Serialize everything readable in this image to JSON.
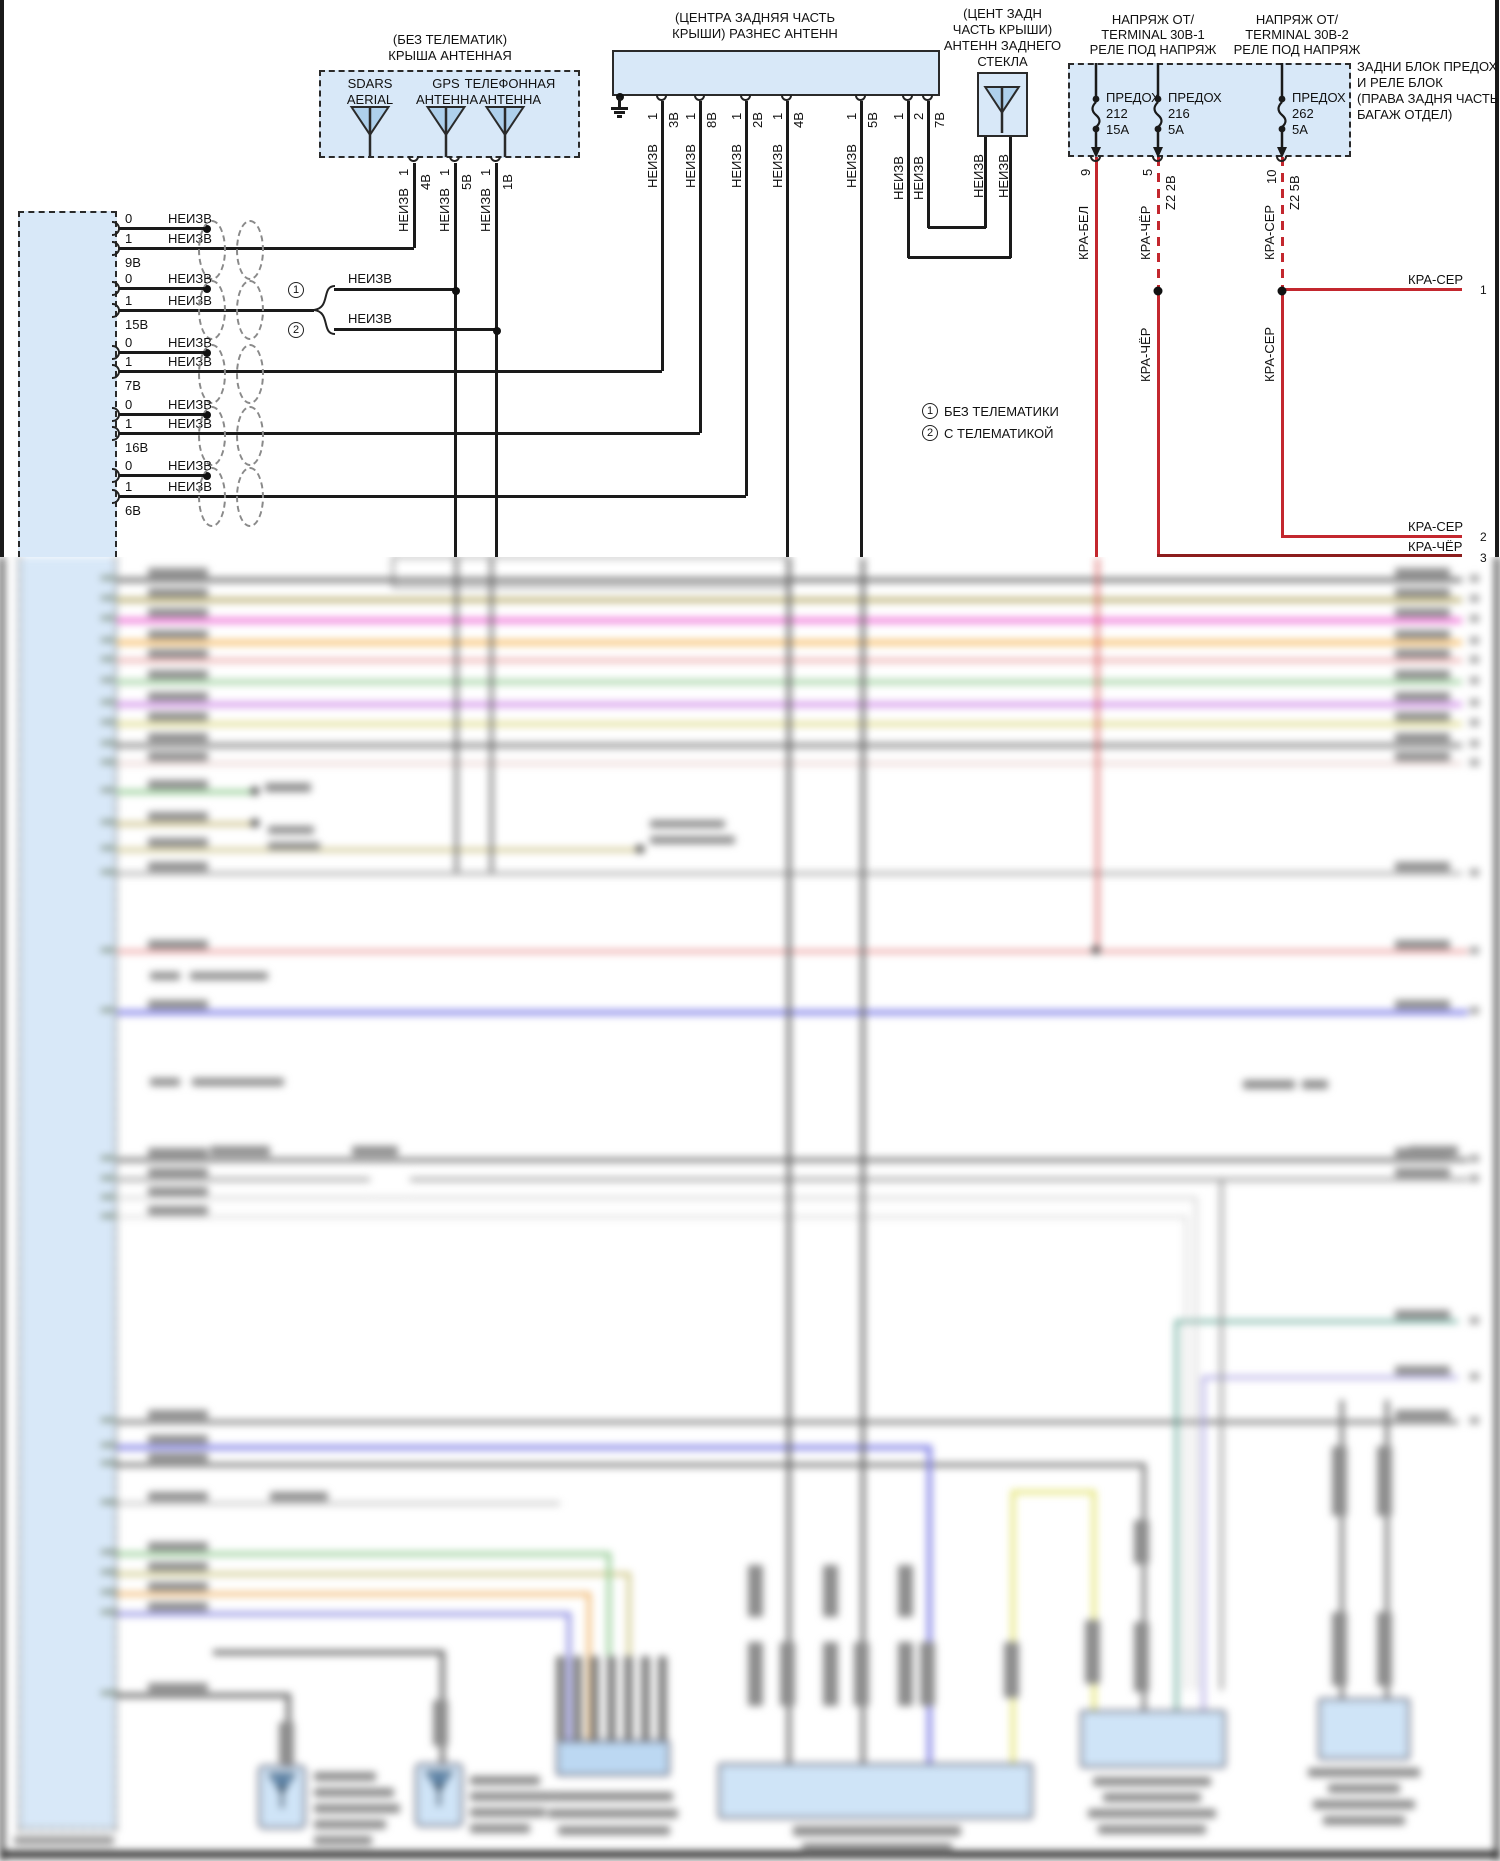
{
  "page": {
    "background": "#ffffff",
    "wire_color": "#1a1a1a",
    "box_fill": "#d8e8f8",
    "power_wire_red": "#c3272e"
  },
  "roof_antenna_module": {
    "title_line1": "(БЕЗ ТЕЛЕМАТИК)",
    "title_line2": "КРЫША АНТЕННАЯ",
    "antennas": [
      {
        "line1": "SDARS",
        "line2": "AERIAL"
      },
      {
        "line1": "GPS",
        "line2": "АНТЕННА"
      },
      {
        "line1": "ТЕЛЕФОННАЯ",
        "line2": "АНТЕННА"
      }
    ],
    "pins": [
      {
        "pin": "1",
        "connector": "4В",
        "wire": "НЕИЗВ"
      },
      {
        "pin": "1",
        "connector": "5В",
        "wire": "НЕИЗВ"
      },
      {
        "pin": "1",
        "connector": "1В",
        "wire": "НЕИЗВ"
      }
    ]
  },
  "diversity_antenna_module": {
    "title_line1": "(ЦЕНТРА ЗАДНЯЯ ЧАСТЬ",
    "title_line2": "КРЫШИ) РАЗНЕС АНТЕНН",
    "pins": [
      {
        "pin": "1",
        "connector": "3В",
        "wire": "НЕИЗВ"
      },
      {
        "pin": "1",
        "connector": "8В",
        "wire": "НЕИЗВ"
      },
      {
        "pin": "1",
        "connector": "2В",
        "wire": "НЕИЗВ"
      },
      {
        "pin": "1",
        "connector": "4В",
        "wire": "НЕИЗВ"
      },
      {
        "pin": "1",
        "connector": "5В",
        "wire": "НЕИЗВ"
      },
      {
        "pin": "1",
        "connector": "",
        "wire": "НЕИЗВ"
      },
      {
        "pin": "2",
        "connector": "7В",
        "wire": "НЕИЗВ"
      }
    ]
  },
  "rear_glass_antenna": {
    "title_lines": [
      "(ЦЕНТ ЗАДН",
      "ЧАСТЬ КРЫШИ)",
      "АНТЕНН ЗАДНЕГО",
      "СТЕКЛА"
    ],
    "wires": [
      "НЕИЗВ",
      "НЕИЗВ"
    ]
  },
  "fuse_block": {
    "supply1_lines": [
      "НАПРЯЖ ОТ/",
      "TERMINAL 30В-1",
      "РЕЛЕ ПОД НАПРЯЖ"
    ],
    "supply2_lines": [
      "НАПРЯЖ ОТ/",
      "TERMINAL 30В-2",
      "РЕЛЕ ПОД НАПРЯЖ"
    ],
    "block_label_lines": [
      "ЗАДНИ БЛОК ПРЕДОХ",
      "И РЕЛЕ БЛОК",
      "(ПРАВА ЗАДНЯ ЧАСТЬ",
      "БАГАЖ ОТДЕЛ)"
    ],
    "fuses": [
      {
        "name": "ПРЕДОХ",
        "number": "212",
        "rating": "15А",
        "pin": "9",
        "connector": ""
      },
      {
        "name": "ПРЕДОХ",
        "number": "216",
        "rating": "5А",
        "pin": "5",
        "connector": "Z2 2В"
      },
      {
        "name": "ПРЕДОХ",
        "number": "262",
        "rating": "5А",
        "pin": "10",
        "connector": "Z2 5В"
      }
    ],
    "wire_labels": {
      "fuse1": "КРА-БЕЛ",
      "fuse2": "КРА-ЧЁР",
      "fuse3": "КРА-СЕР"
    }
  },
  "ecu_connector": {
    "rows": [
      {
        "pin_a": "0",
        "pin_b": "1",
        "wire_a": "НЕИЗВ",
        "wire_b": "НЕИЗВ",
        "connector": "9В"
      },
      {
        "pin_a": "0",
        "pin_b": "1",
        "wire_a": "НЕИЗВ",
        "wire_b": "НЕИЗВ",
        "connector": "15В"
      },
      {
        "pin_a": "0",
        "pin_b": "1",
        "wire_a": "НЕИЗВ",
        "wire_b": "НЕИЗВ",
        "connector": "7В"
      },
      {
        "pin_a": "0",
        "pin_b": "1",
        "wire_a": "НЕИЗВ",
        "wire_b": "НЕИЗВ",
        "connector": "16В"
      },
      {
        "pin_a": "0",
        "pin_b": "1",
        "wire_a": "НЕИЗВ",
        "wire_b": "НЕИЗВ",
        "connector": "6В"
      }
    ]
  },
  "variant_branch": {
    "circle1": "1",
    "circle2": "2",
    "option1_wire": "НЕИЗВ",
    "option2_wire": "НЕИЗВ"
  },
  "legend": [
    {
      "symbol": "1",
      "text": "БЕЗ ТЕЛЕМАТИКИ"
    },
    {
      "symbol": "2",
      "text": "С ТЕЛЕМАТИКОЙ"
    }
  ],
  "right_edge_pins": [
    {
      "wire": "КРА-СЕР",
      "pin": "1"
    },
    {
      "wire": "КРА-СЕР",
      "pin": "2"
    },
    {
      "wire": "КРА-ЧЁР",
      "pin": "3"
    }
  ]
}
